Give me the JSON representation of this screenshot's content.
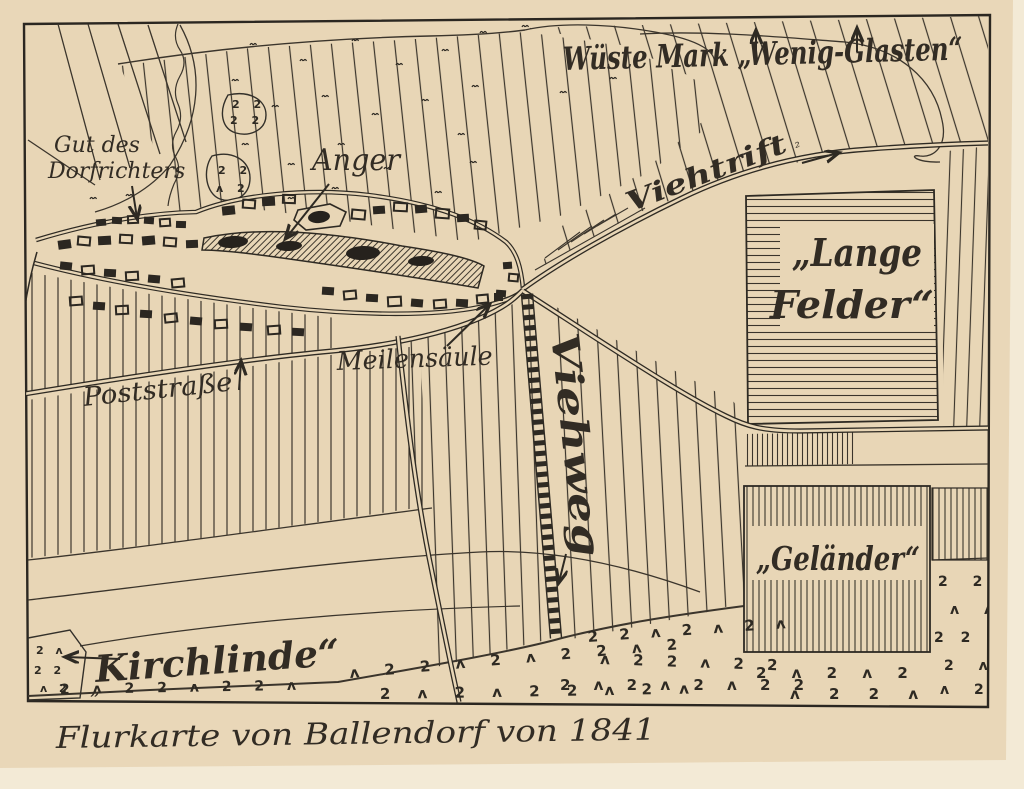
{
  "map": {
    "caption": "Flurkarte von Ballendorf von 1841",
    "labels": {
      "wueste_mark": "Wüste Mark „Wenig-Glasten“",
      "gut_line1": "Gut des",
      "gut_line2": "Dorfrichters",
      "anger": "Anger",
      "viehtrift": "Viehtrift",
      "viehtrift_mark": "²",
      "lange_felder_line1": "„Lange",
      "lange_felder_line2": "Felder“",
      "meilensaeule": "Meilensäule",
      "poststrasse": "Poststraße",
      "viehweg": "Viehweg",
      "gelaender": "„Geländer“",
      "kirchlinde": "Kirchlinde“",
      "patch_quote": "„"
    },
    "colors": {
      "paper": "#e9d7b8",
      "ink": "#322c24",
      "backing": "#f3ead6"
    },
    "scrub": [
      "2 ʌ 2 2 ʌ 2 2 ʌ",
      "ʌ 2 2 ʌ 2 ʌ 2 2 ʌ 2",
      "2 ʌ 2 ʌ 2 2 ʌ 2 ʌ",
      "2 2 ʌ 2 ʌ 2 ʌ",
      "ʌ 2 2 ʌ 2 2",
      "2 ʌ 2 ʌ 2 ʌ 2 2",
      "2 ʌ 2 ʌ 2",
      "ʌ 2 2 ʌ",
      "2 2",
      "ʌ ʌ",
      "2 2 ʌ",
      "2 ʌ",
      "ʌ 2",
      "2 ʌ",
      "2 2",
      "ʌ 2",
      "2 2",
      "2 2",
      "2 2",
      "ʌ 2"
    ]
  }
}
